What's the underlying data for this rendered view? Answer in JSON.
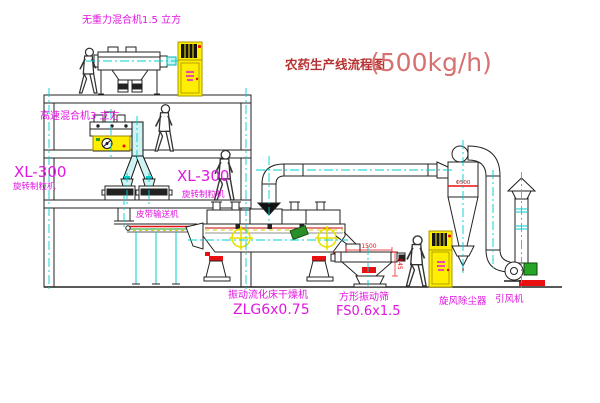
{
  "title": {
    "flow_title": "农药生产线流程图",
    "capacity": "(500kg/h)"
  },
  "labels": {
    "gravity_free_mixer": "无重力混合机1.5 立方",
    "high_speed_mixer": "高速混合机3 立方",
    "granulator_left_model": "XL-300",
    "granulator_left_name": "旋转制粒机",
    "granulator_right_model": "XL-300",
    "granulator_right_name": "旋转制粒机",
    "belt_conveyor": "皮带输送机",
    "dryer_name": "振动流化床干燥机",
    "dryer_model": "ZLG6x0.75",
    "sieve_name": "方形振动筛",
    "sieve_model": "FS0.6x1.5",
    "cyclone": "旋风除尘器",
    "fan": "引风机"
  },
  "dimensions": {
    "sieve_length": "1500",
    "sieve_height": "545",
    "cyclone_dia": "Φ500"
  },
  "colors": {
    "label_magenta": "#e016e0",
    "title_red": "#b73333",
    "capacity_red": "#d97070",
    "accent_red": "#e81010",
    "centerline_cyan": "#00cfcf",
    "cabinet_yellow": "#ffee00",
    "duct_fill": "#cff3f3",
    "line_black": "#222222"
  }
}
